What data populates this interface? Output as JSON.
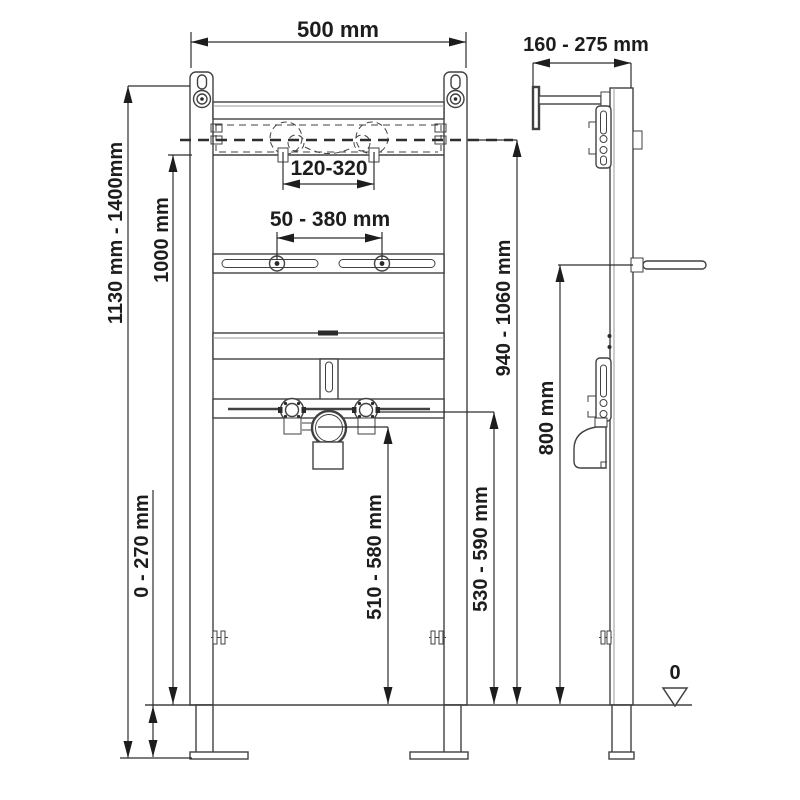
{
  "diagram": {
    "kind": "washbasin-installation-frame-dimension-drawing",
    "colors": {
      "background": "#ffffff",
      "line": "#414141",
      "dimension_line": "#2e2e2e",
      "text": "#1d1d1d"
    },
    "labels": {
      "frame_width": "500 mm",
      "install_depth": "160 - 275 mm",
      "frame_height": "1130 mm - 1400mm",
      "upper_rail_height": "1000 mm",
      "tap_hole_spacing": "120-320",
      "fixing_spacing": "50 - 380 mm",
      "basin_rim_height": "940 - 1060 mm",
      "mid_height": "800 mm",
      "drain_outlet_height": "510 - 580 mm",
      "water_supply_height": "530 - 590 mm",
      "foot_adjustment": "0 - 270 mm",
      "floor_datum": "0"
    }
  }
}
